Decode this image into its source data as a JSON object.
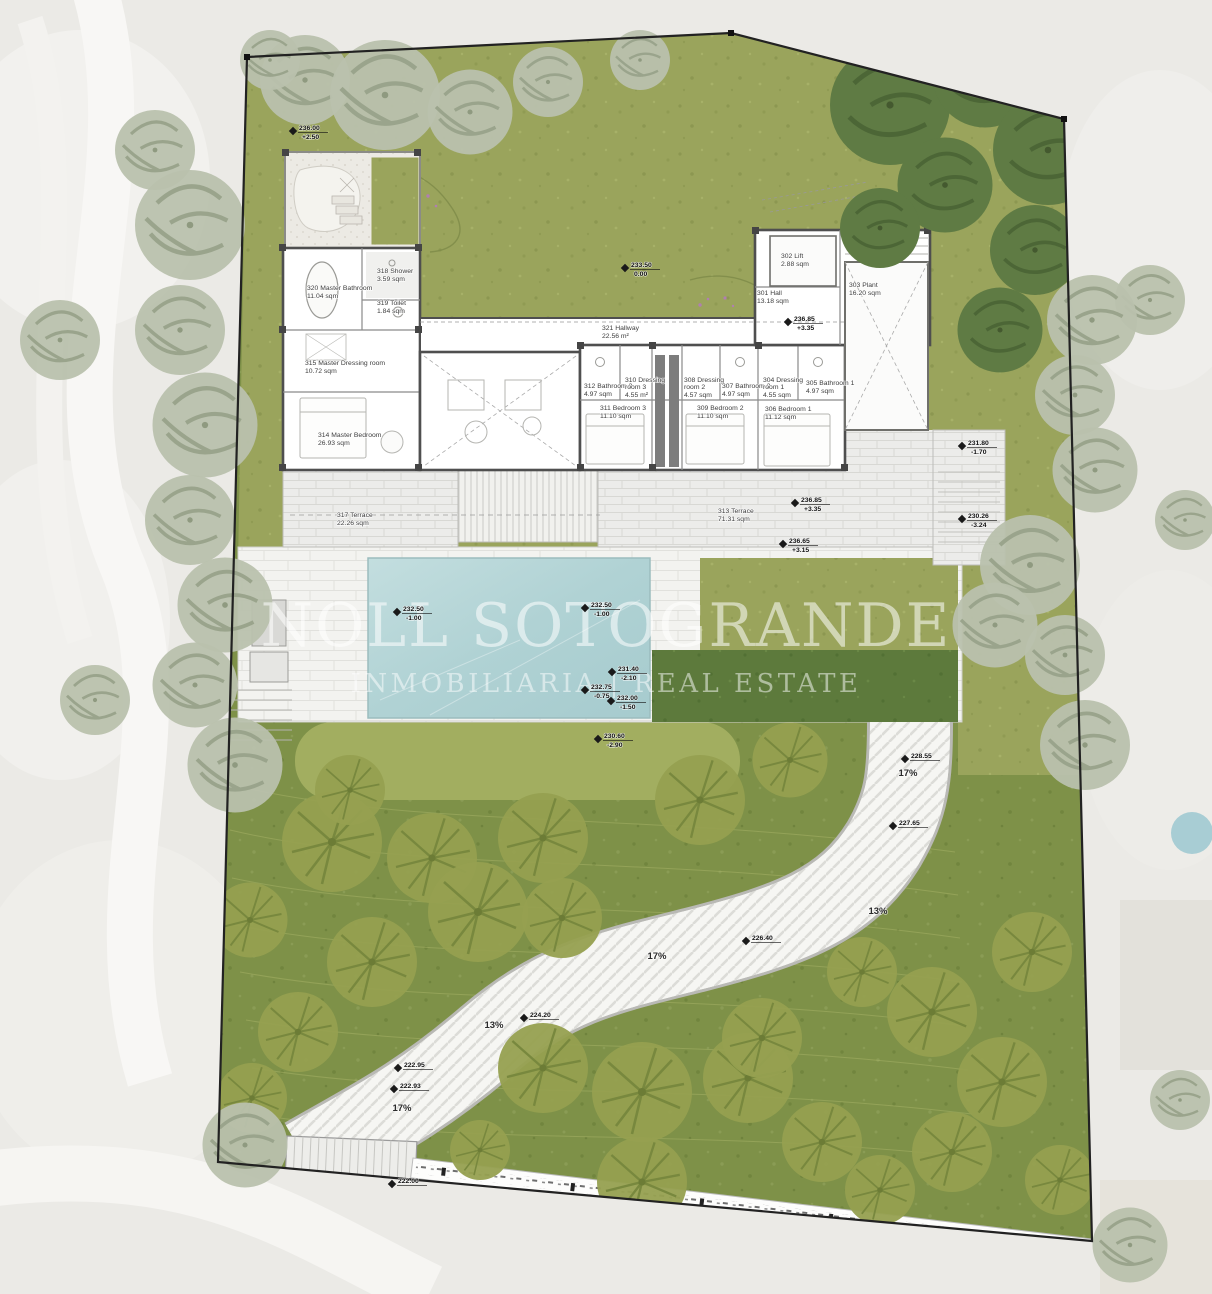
{
  "watermark": {
    "line1": "NOLL SOTOGRANDE",
    "line2": "INMOBILIARIA | REAL ESTATE"
  },
  "rooms": {
    "r301": {
      "name": "301 Hall",
      "area": "13.18 sqm"
    },
    "r302": {
      "name": "302 Lift",
      "area": "2.88 sqm"
    },
    "r303": {
      "name": "303 Plant",
      "area": "16.20 sqm"
    },
    "r304": {
      "name": "304 Dressing",
      "name2": "room 1",
      "area": "4.55 sqm"
    },
    "r305": {
      "name": "305 Bathroom 1",
      "area": "4.97 sqm"
    },
    "r306": {
      "name": "306 Bedroom 1",
      "area": "11.12 sqm"
    },
    "r307": {
      "name": "307 Bathroom 2",
      "area": "4.97 sqm"
    },
    "r308": {
      "name": "308 Dressing",
      "name2": "room 2",
      "area": "4.57 sqm"
    },
    "r309": {
      "name": "309 Bedroom 2",
      "area": "11.10 sqm"
    },
    "r310": {
      "name": "310 Dressing",
      "name2": "room 3",
      "area": "4.55 m²"
    },
    "r311": {
      "name": "311 Bedroom 3",
      "area": "11.10 sqm"
    },
    "r312": {
      "name": "312 Bathroom 3",
      "area": "4.97 sqm"
    },
    "r313": {
      "name": "313 Terrace",
      "area": "71.31 sqm"
    },
    "r314": {
      "name": "314 Master Bedroom",
      "area": "26.93 sqm"
    },
    "r315": {
      "name": "315 Master Dressing room",
      "area": "10.72 sqm"
    },
    "r317": {
      "name": "317 Terrace",
      "area": "22.26 sqm"
    },
    "r318": {
      "name": "318 Shower",
      "area": "3.59 sqm"
    },
    "r319": {
      "name": "319 Toilet",
      "area": "1.84 sqm"
    },
    "r320": {
      "name": "320 Master Bathroom",
      "area": "11.04 sqm"
    },
    "r321": {
      "name": "321 Hallway",
      "area": "22.56 m²"
    }
  },
  "levels": {
    "m1": {
      "v": "236.00",
      "r": "+2.50"
    },
    "m2": {
      "v": "233.50",
      "r": "0.00"
    },
    "m3": {
      "v": "236.85",
      "r": "+3.35"
    },
    "m4": {
      "v": "236.85",
      "r": "+3.35"
    },
    "m5": {
      "v": "236.65",
      "r": "+3.15"
    },
    "m6": {
      "v": "231.80",
      "r": "-1.70"
    },
    "m7": {
      "v": "230.26",
      "r": "-3.24"
    },
    "m8": {
      "v": "232.50",
      "r": "-1.00"
    },
    "m9": {
      "v": "232.50",
      "r": "-1.00"
    },
    "m10": {
      "v": "231.40",
      "r": "-2.10"
    },
    "m11": {
      "v": "232.75",
      "r": "-0.75"
    },
    "m12": {
      "v": "232.00",
      "r": "-1.50"
    },
    "m13": {
      "v": "230.60",
      "r": "-2.90"
    },
    "m14": {
      "v": "228.55"
    },
    "m15": {
      "v": "227.65"
    },
    "m16": {
      "v": "226.40"
    },
    "m17": {
      "v": "224.20"
    },
    "m18": {
      "v": "222.95"
    },
    "m19": {
      "v": "222.93"
    },
    "m20": {
      "v": "222.00"
    }
  },
  "slopes": {
    "s1": "17%",
    "s2": "13%",
    "s3": "17%",
    "s4": "13%",
    "s5": "17%"
  },
  "colors": {
    "upper_lawn": "#9aa45c",
    "lower_garden": "#7e9148",
    "hedge": "#5d7a3c",
    "pool_water": "#b7d6d8",
    "paving": "#f4f4f1",
    "boundary": "#222222"
  }
}
